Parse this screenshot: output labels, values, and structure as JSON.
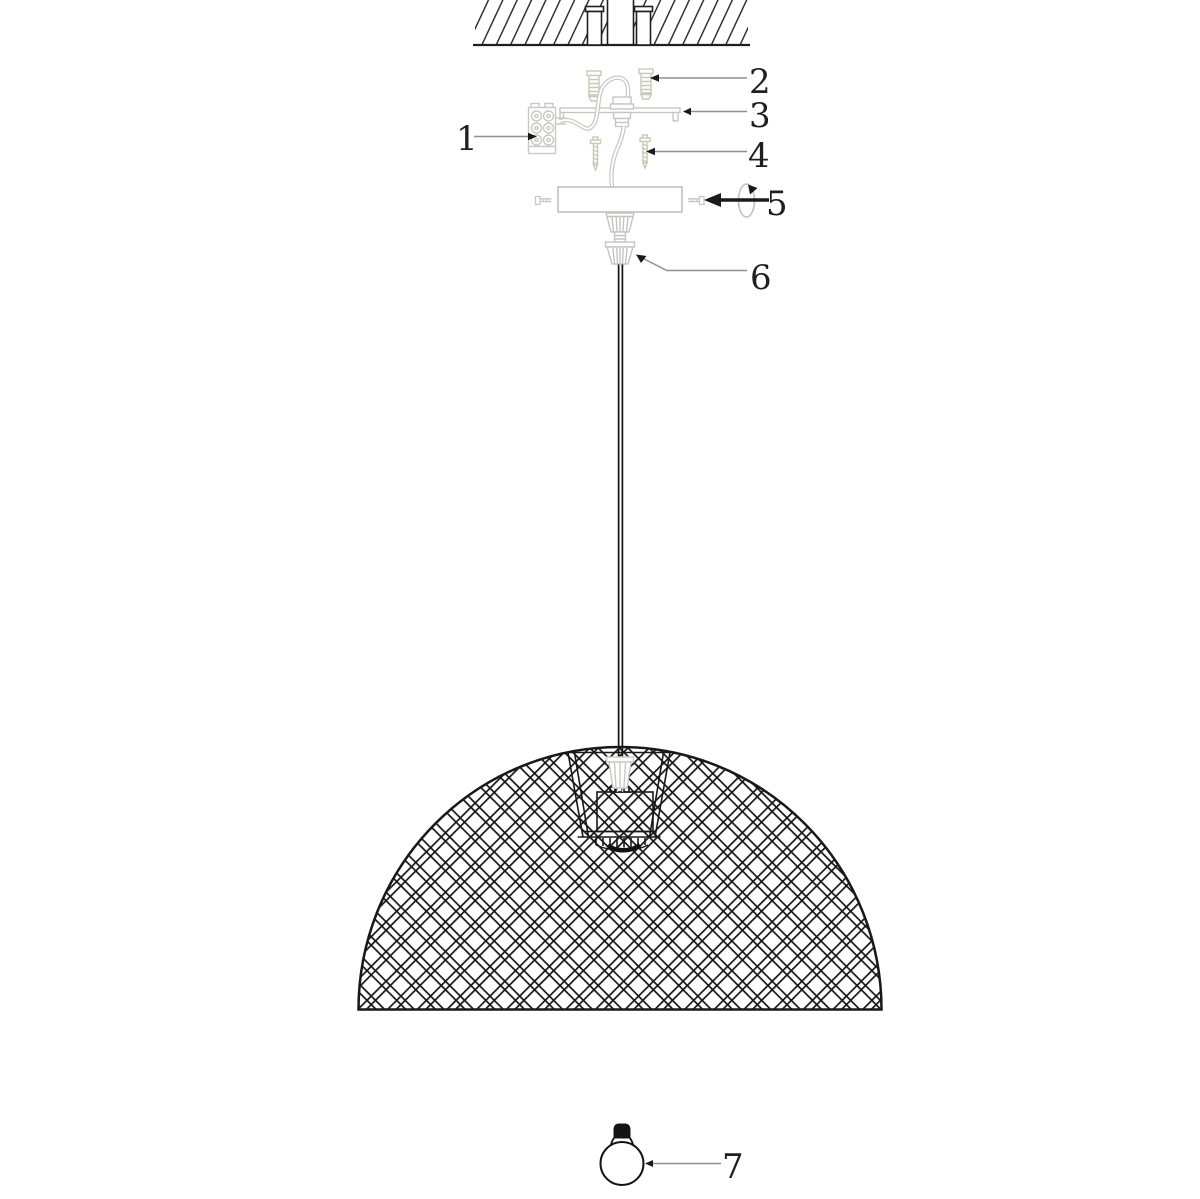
{
  "labels": [
    "1",
    "2",
    "3",
    "4",
    "5",
    "6",
    "7"
  ],
  "colors": {
    "ink": "#1f1f1f",
    "faint": "#c9c9c3",
    "leader": "#909090",
    "background": "#ffffff"
  }
}
